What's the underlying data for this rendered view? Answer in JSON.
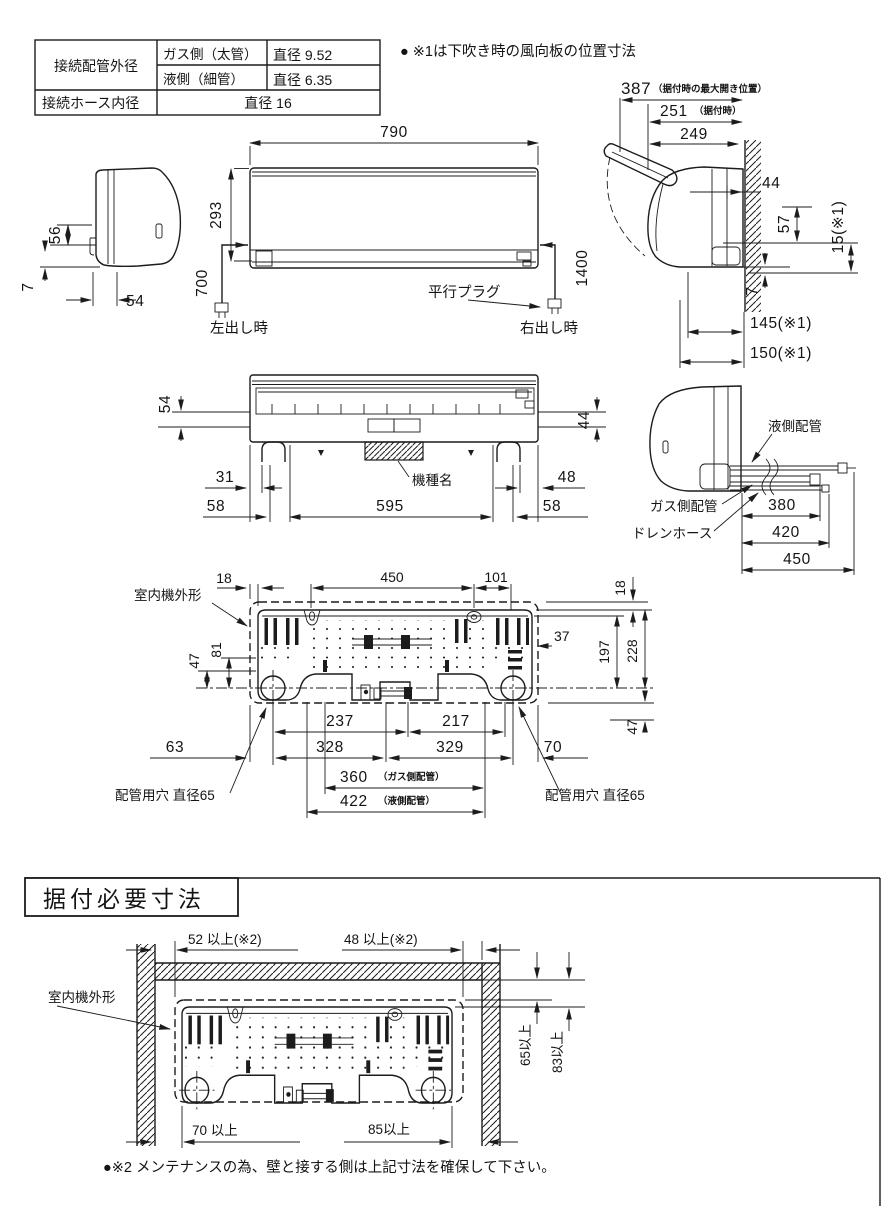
{
  "colors": {
    "line": "#1c1c1c",
    "background": "#ffffff"
  },
  "spec_table": {
    "pipe_od_label": "接続配管外径",
    "gas_name": "ガス側（太管）",
    "gas_value": "直径 9.52",
    "liquid_name": "液側（細管）",
    "liquid_value": "直径 6.35",
    "hose_label": "接続ホース内径",
    "hose_value": "直径 16"
  },
  "notes": {
    "note1": "● ※1は下吹き時の風向板の位置寸法",
    "note2": "●※2 メンテナンスの為、壁と接する側は上記寸法を確保して下さい。"
  },
  "left_side_view": {
    "h56": "56",
    "h7": "7",
    "w54": "54"
  },
  "front_view": {
    "w790": "790",
    "h293": "293",
    "cord_left": "700",
    "cord_right": "1400",
    "plug": "平行プラグ",
    "left_out": "左出し時",
    "right_out": "右出し時"
  },
  "right_side_view": {
    "w387": "387",
    "w387_note": "（据付時の最大開き位置）",
    "w251": "251",
    "w251_note": "（据付時）",
    "w249": "249",
    "d44": "44",
    "d57": "57",
    "d15": "15(※1)",
    "d7": "7",
    "d145": "145(※1)",
    "d150": "150(※1)"
  },
  "bottom_view": {
    "h54": "54",
    "h44": "44",
    "w31": "31",
    "w48": "48",
    "w58_left": "58",
    "w595": "595",
    "w58_right": "58",
    "model": "機種名"
  },
  "piping_view": {
    "liquid": "液側配管",
    "gas": "ガス側配管",
    "drain": "ドレンホース",
    "l380": "380",
    "l420": "420",
    "l450": "450"
  },
  "back_plate": {
    "outline": "室内機外形",
    "t18l": "18",
    "t450": "450",
    "t101": "101",
    "t18r": "18",
    "l47": "47",
    "l81": "81",
    "r37": "37",
    "r197": "197",
    "r228": "228",
    "r47": "47",
    "b237": "237",
    "b217": "217",
    "b63": "63",
    "b328": "328",
    "b329": "329",
    "b70": "70",
    "b360": "360",
    "b360_note": "（ガス側配管）",
    "b422": "422",
    "b422_note": "（液側配管）",
    "hole_left": "配管用穴 直径65",
    "hole_right": "配管用穴 直径65"
  },
  "install": {
    "title": "据付必要寸法",
    "outline": "室内機外形",
    "top_left": "52 以上(※2)",
    "top_right": "48 以上(※2)",
    "right_65": "65以上",
    "right_83": "83以上",
    "bottom_left": "70 以上",
    "bottom_right": "85以上"
  }
}
